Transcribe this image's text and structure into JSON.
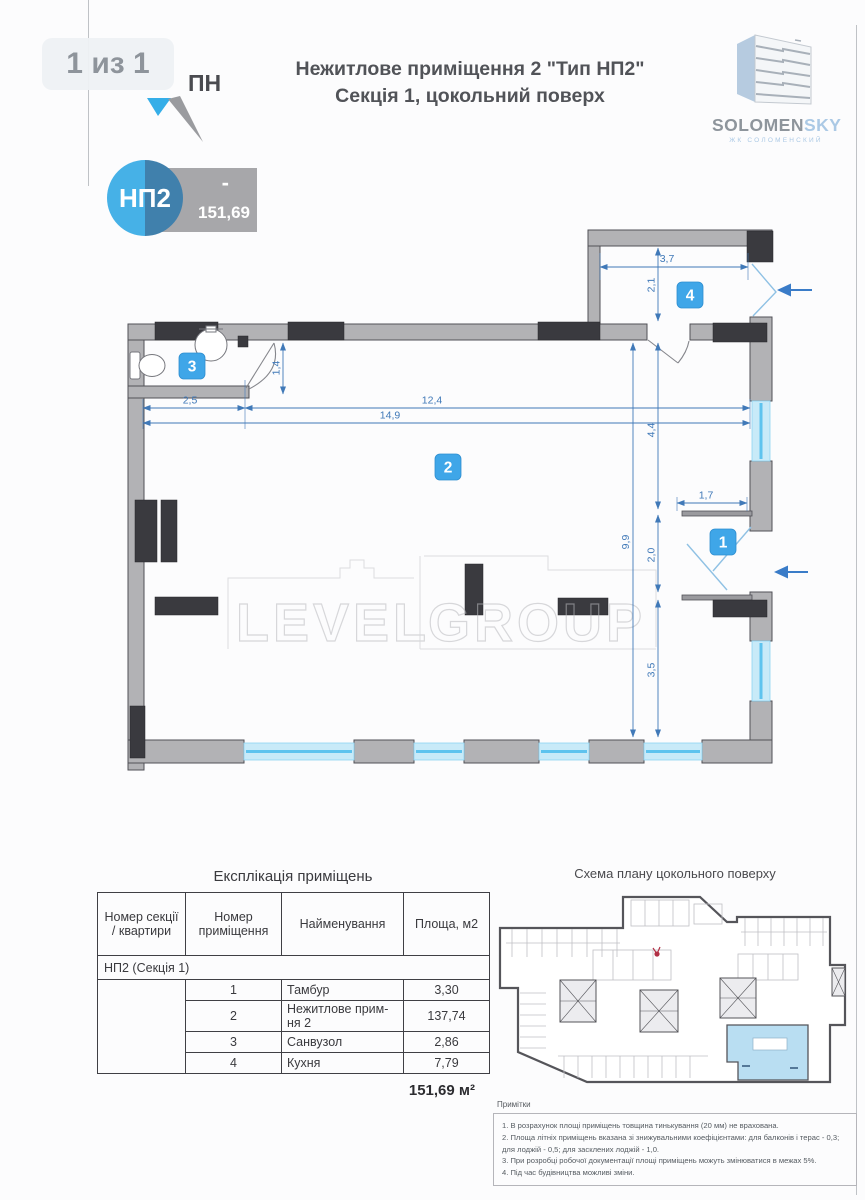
{
  "page": {
    "counter": "1 из 1"
  },
  "compass": {
    "label": "ПН"
  },
  "header": {
    "title_line1": "Нежитлове приміщення 2 \"Тип НП2\"",
    "title_line2": "Секція 1, цокольний поверх"
  },
  "logo": {
    "brand_gray": "SOLOMEN",
    "brand_blue": "SKY",
    "subtitle": "ЖК СОЛОМЕНСКИЙ"
  },
  "unit_card": {
    "code": "НП2",
    "floor_dash": "-",
    "area": "151,69"
  },
  "plan": {
    "badges": {
      "tambour": "1",
      "main": "2",
      "bathroom": "3",
      "kitchen": "4"
    },
    "dims": {
      "kitchen_width": "3,7",
      "kitchen_depth": "2,1",
      "bathroom_depth": "1,4",
      "bathroom_width": "2,5",
      "main_width": "12,4",
      "total_width": "14,9",
      "upper_depth": "4,4",
      "total_depth": "9,9",
      "tambour_width": "1,7",
      "tambour_depth": "2,0",
      "lower_depth": "3,5"
    }
  },
  "watermark": {
    "word_left": "LEVEL",
    "word_right": "GROUP"
  },
  "explication": {
    "title": "Експлікація приміщень",
    "columns": [
      "Номер секції / квартири",
      "Номер приміщення",
      "Найменування",
      "Площа, м2"
    ],
    "group_row": "НП2 (Секція 1)",
    "rows": [
      {
        "number": "1",
        "name": "Тамбур",
        "area": "3,30"
      },
      {
        "number": "2",
        "name": "Нежитлове прим-ня 2",
        "area": "137,74"
      },
      {
        "number": "3",
        "name": "Санвузол",
        "area": "2,86"
      },
      {
        "number": "4",
        "name": "Кухня",
        "area": "7,79"
      }
    ],
    "total": "151,69 м²"
  },
  "scheme": {
    "title": "Схема плану цокольного поверху"
  },
  "notes": {
    "title": "Примітки",
    "items": [
      "1. В розрахунок площі приміщень товщина тинькування (20 мм) не врахована.",
      "2. Площа літніх приміщень вказана зі знижувальними коефіцієнтами: для балконів і терас - 0,3; для лоджій - 0,5; для засклених лоджій - 1,0.",
      "3. При розробці робочої документації площі приміщень можуть змінюватися в межах 5%.",
      "4. Під час будівництва можливі зміни."
    ]
  },
  "colors": {
    "accent_blue": "#3fa6e8",
    "dim_blue": "#4079b8",
    "window_blue": "#7fd0f2",
    "wall_gray": "#b2b2b5",
    "dark_block": "#3a3a3f",
    "entry_arrow": "#3a7cc8"
  }
}
